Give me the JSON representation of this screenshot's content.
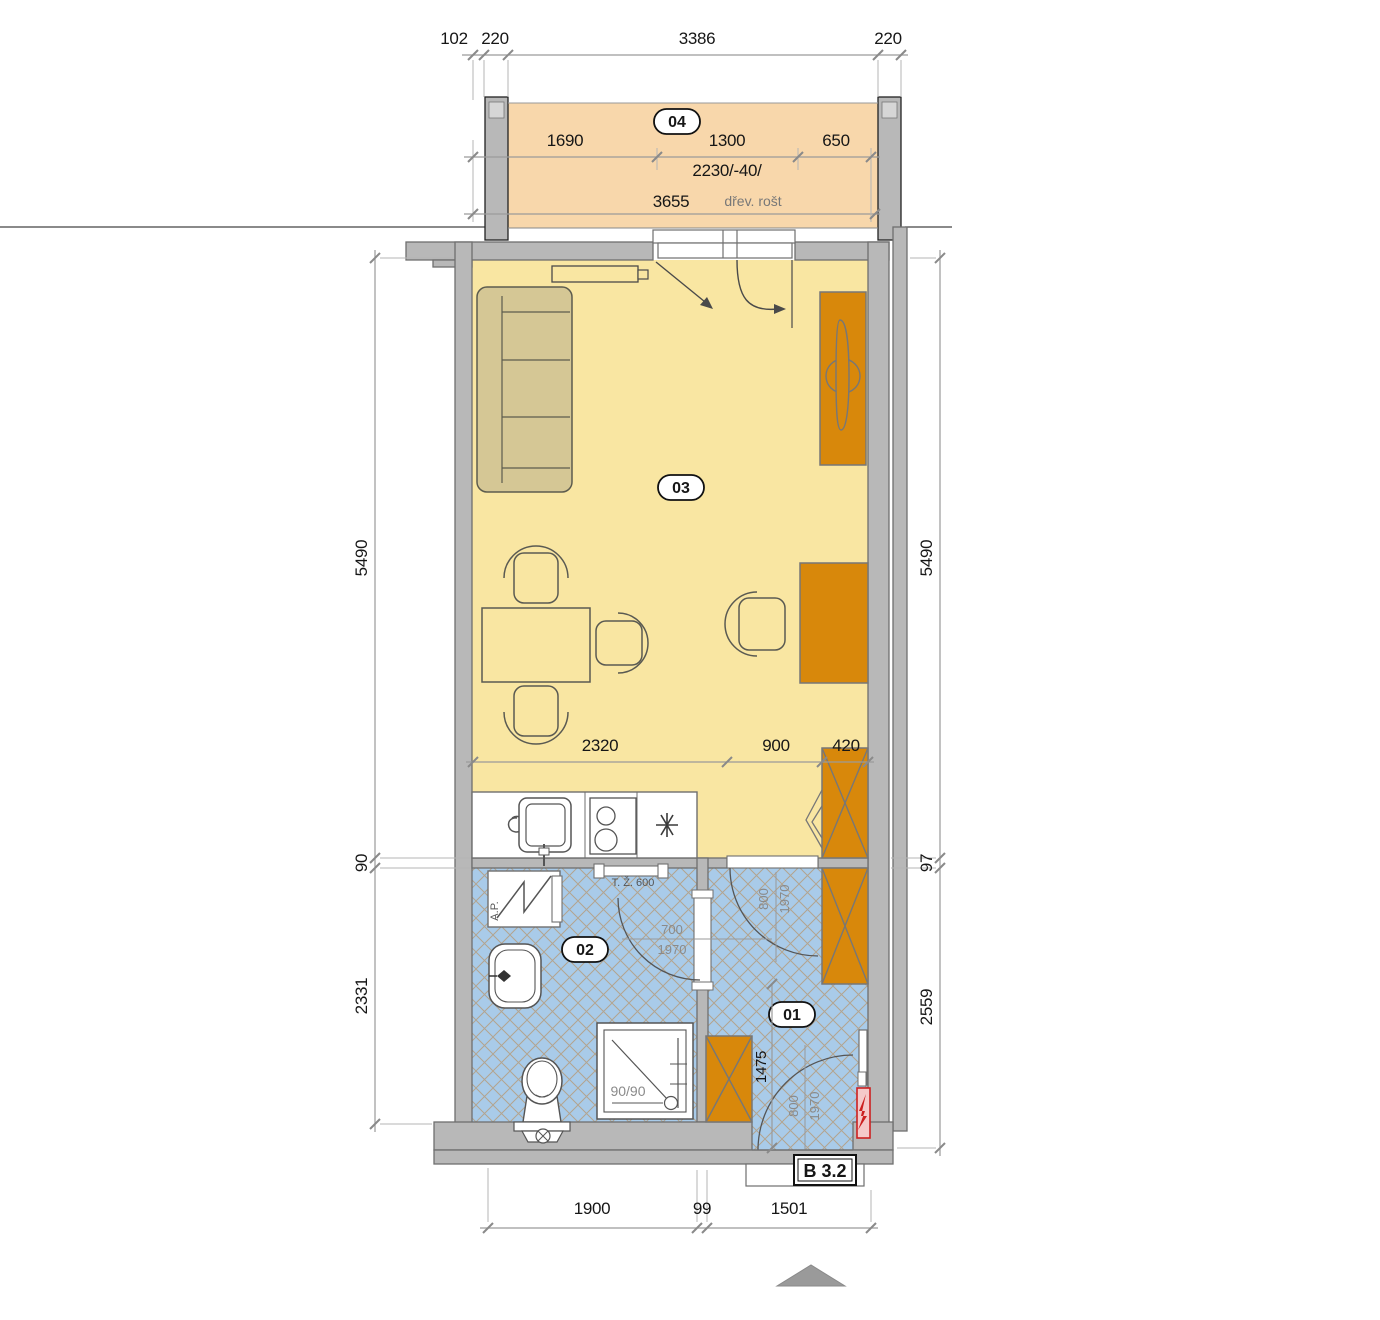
{
  "unit": {
    "label": "B 3.2"
  },
  "rooms": {
    "hall": {
      "number": "01"
    },
    "bath": {
      "number": "02"
    },
    "living": {
      "number": "03"
    },
    "balcony": {
      "number": "04"
    }
  },
  "dims": {
    "top": [
      "102",
      "220",
      "3386",
      "220"
    ],
    "balcony": {
      "segments": [
        "1690",
        "1300",
        "650"
      ],
      "window": "2230/-40/",
      "total": "3655"
    },
    "room": [
      "2320",
      "900",
      "420"
    ],
    "left": [
      "5490",
      "90",
      "2331"
    ],
    "right": [
      "5490",
      "97",
      "2559"
    ],
    "bottom": [
      "1900",
      "99",
      "1501"
    ],
    "hall_depth": "1475"
  },
  "doors": {
    "bath": {
      "w": "700",
      "h": "1970"
    },
    "living_hall": {
      "w": "800",
      "h": "1970"
    },
    "entrance": {
      "w": "800",
      "h": "1970"
    }
  },
  "labels": {
    "washing_machine": "A.P.",
    "towel_rail": "T. Ž. 600",
    "shower": "90/90",
    "wood_grate": "dřev. rošt"
  },
  "colors": {
    "living_floor": "#f9e6a2",
    "balcony_floor": "#f8d7ab",
    "wet_floor": "#a9cbe9",
    "hatch_line": "#b59a78",
    "wall": "#b8b8b8",
    "wall_edge": "#6f6f6f",
    "furniture_wood": "#d8880b",
    "sofa": "#d5c795",
    "electric_panel": "#cc2020"
  }
}
